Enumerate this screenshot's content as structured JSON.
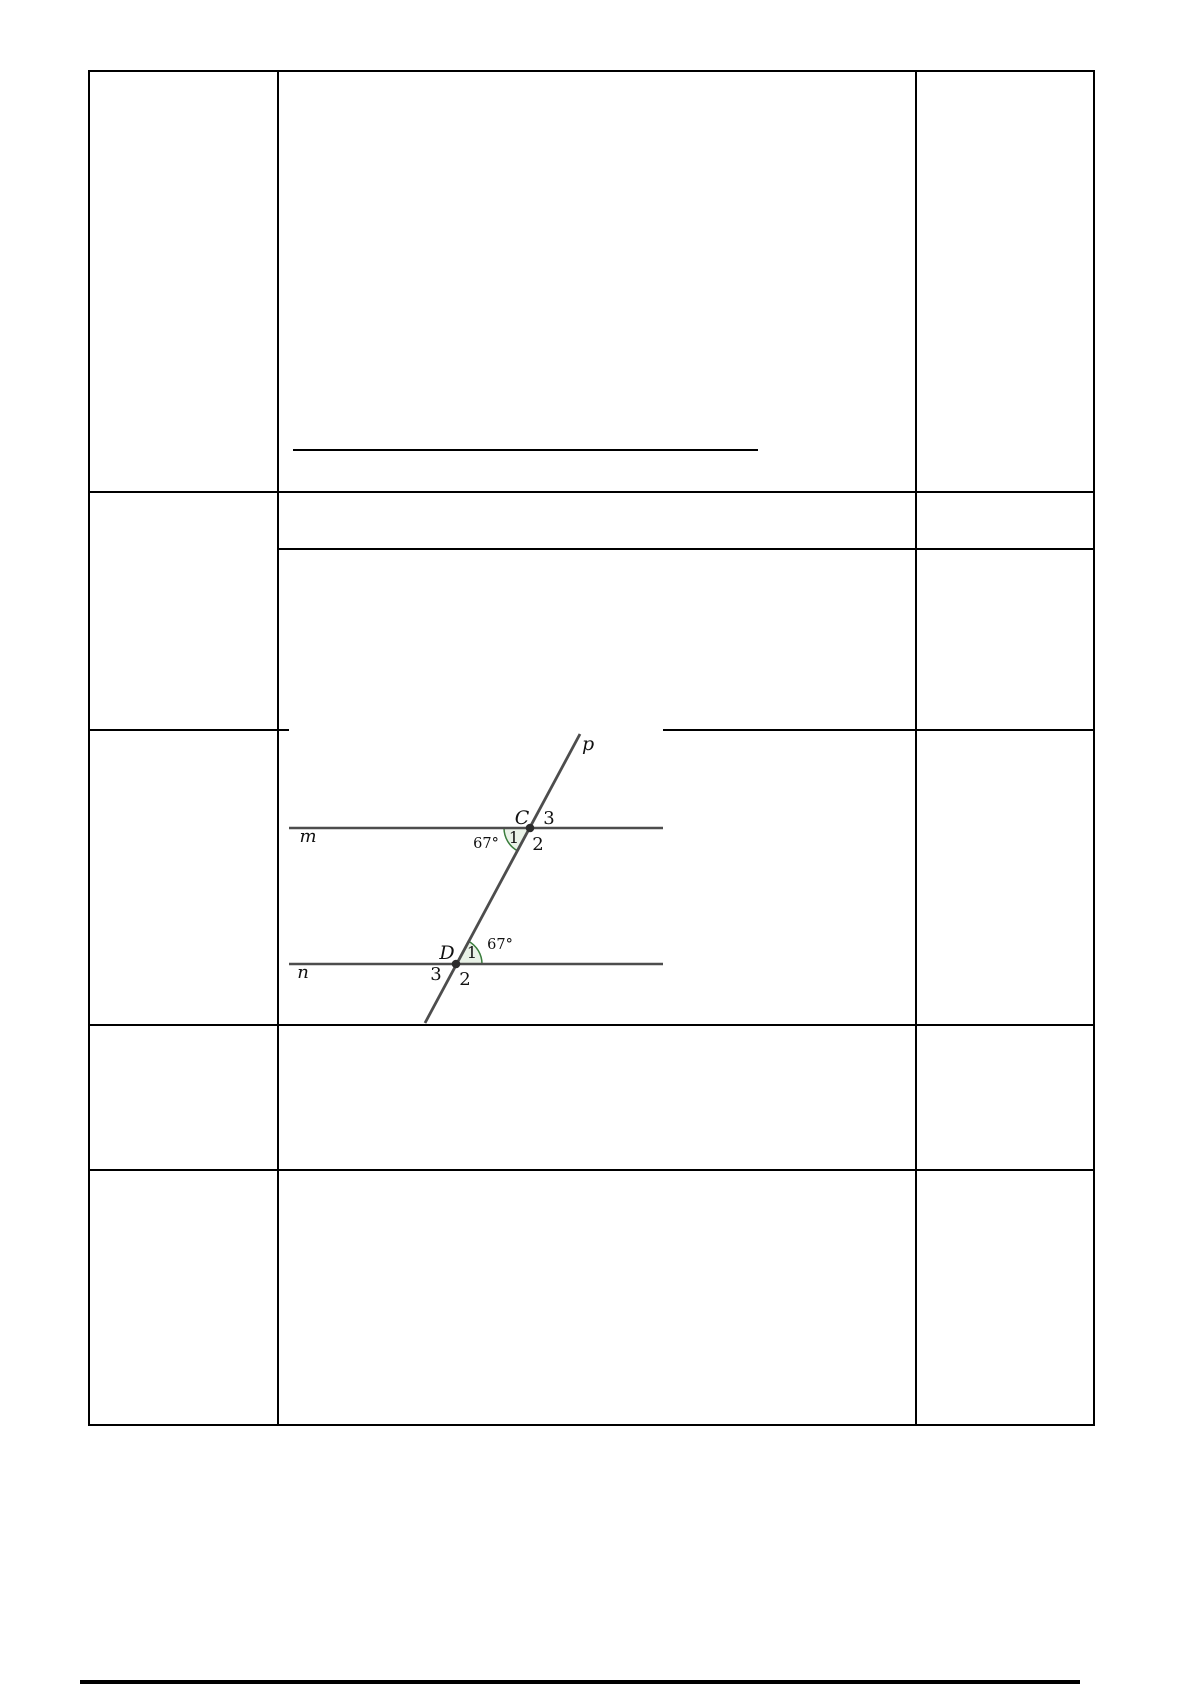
{
  "page": {
    "background": "#ffffff",
    "table_border_color": "#000000"
  },
  "diagram": {
    "labels": {
      "transversal": "p",
      "line_top": "m",
      "line_bottom": "n"
    },
    "point_top": {
      "name": "C",
      "angle_1": "1",
      "angle_2": "2",
      "angle_3": "3",
      "measure": "67°"
    },
    "point_bottom": {
      "name": "D",
      "angle_1": "1",
      "angle_2": "2",
      "angle_3": "3",
      "measure": "67°"
    },
    "colors": {
      "line": "#4d4d4d",
      "angle_fill": "#e9f2e7",
      "angle_stroke": "#3a7d3c",
      "point": "#2b2b2b",
      "label": "#111111"
    }
  }
}
